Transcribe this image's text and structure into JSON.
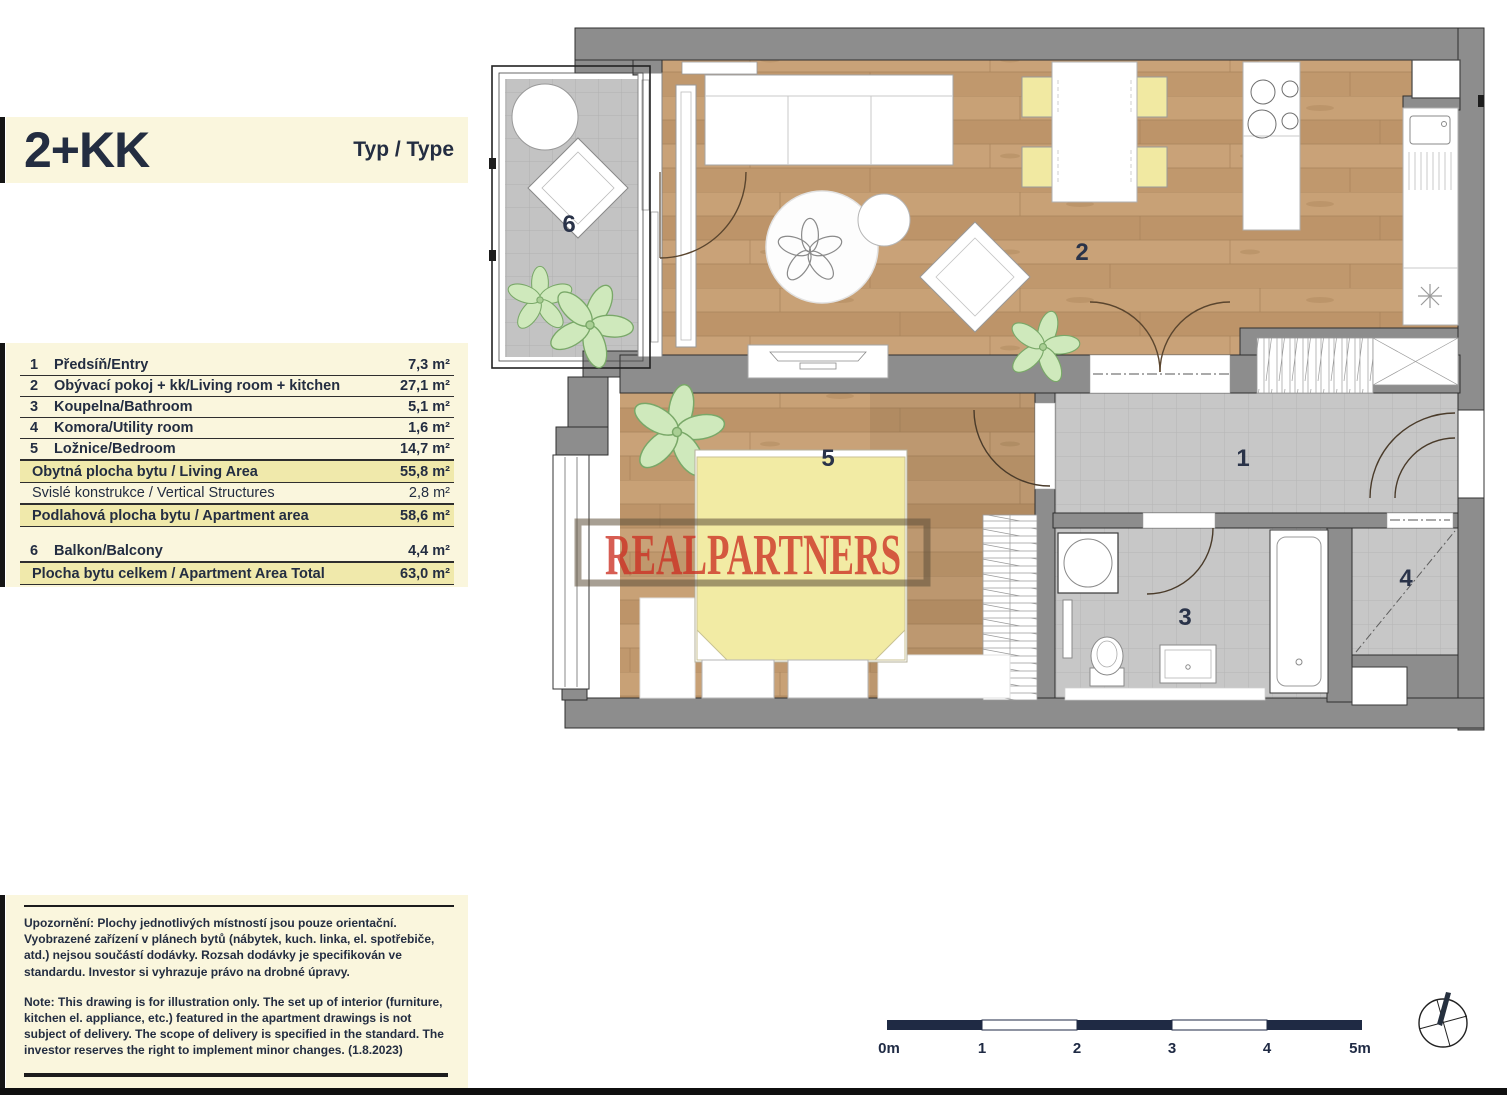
{
  "header": {
    "title": "2+KK",
    "type_label": "Typ / Type"
  },
  "area_table": {
    "rows": [
      {
        "num": "1",
        "label": "Předsíň/Entry",
        "area": "7,3 m²"
      },
      {
        "num": "2",
        "label": "Obývací pokoj + kk/Living room + kitchen",
        "area": "27,1 m²"
      },
      {
        "num": "3",
        "label": "Koupelna/Bathroom",
        "area": "5,1 m²"
      },
      {
        "num": "4",
        "label": "Komora/Utility room",
        "area": "1,6 m²"
      },
      {
        "num": "5",
        "label": "Ložnice/Bedroom",
        "area": "14,7 m²"
      },
      {
        "num": "",
        "label": "Obytná plocha bytu / Living Area",
        "area": "55,8 m²"
      },
      {
        "num": "",
        "label": "Svislé konstrukce / Vertical Structures",
        "area": "2,8 m²"
      },
      {
        "num": "",
        "label": "Podlahová plocha bytu / Apartment area",
        "area": "58,6 m²"
      },
      {
        "num": "6",
        "label": "Balkon/Balcony",
        "area": "4,4 m²"
      },
      {
        "num": "",
        "label": "Plocha bytu celkem / Apartment Area Total",
        "area": "63,0 m²"
      }
    ]
  },
  "notes": {
    "czech": "Upozornění: Plochy jednotlivých místností jsou pouze orientační. Vyobrazené zařízení v plánech bytů (nábytek, kuch. linka, el. spotřebiče, atd.) nejsou součástí dodávky. Rozsah dodávky je specifikován ve standardu. Investor si vyhrazuje právo na drobné úpravy.",
    "english": "Note: This drawing is for illustration only. The set up of interior (furniture, kitchen el. appliance, etc.) featured in the apartment drawings is not subject of delivery. The scope of delivery is specified in the standard. The investor reserves the right to implement minor changes. (1.8.2023)"
  },
  "plan": {
    "watermark": "REALPARTNERS",
    "rooms": [
      "1",
      "2",
      "3",
      "4",
      "5",
      "6"
    ],
    "scale": [
      "0m",
      "1",
      "2",
      "3",
      "4",
      "5m"
    ]
  },
  "colors": {
    "cream": "#faf6dd",
    "highlight_row": "#f0e9ab",
    "navy_text": "#232d41",
    "wall_gray": "#8d8d8d",
    "wood_floor": "#c49d72",
    "watermark_red": "#cc2f23",
    "furniture_yellow": "#f1e9a2"
  }
}
